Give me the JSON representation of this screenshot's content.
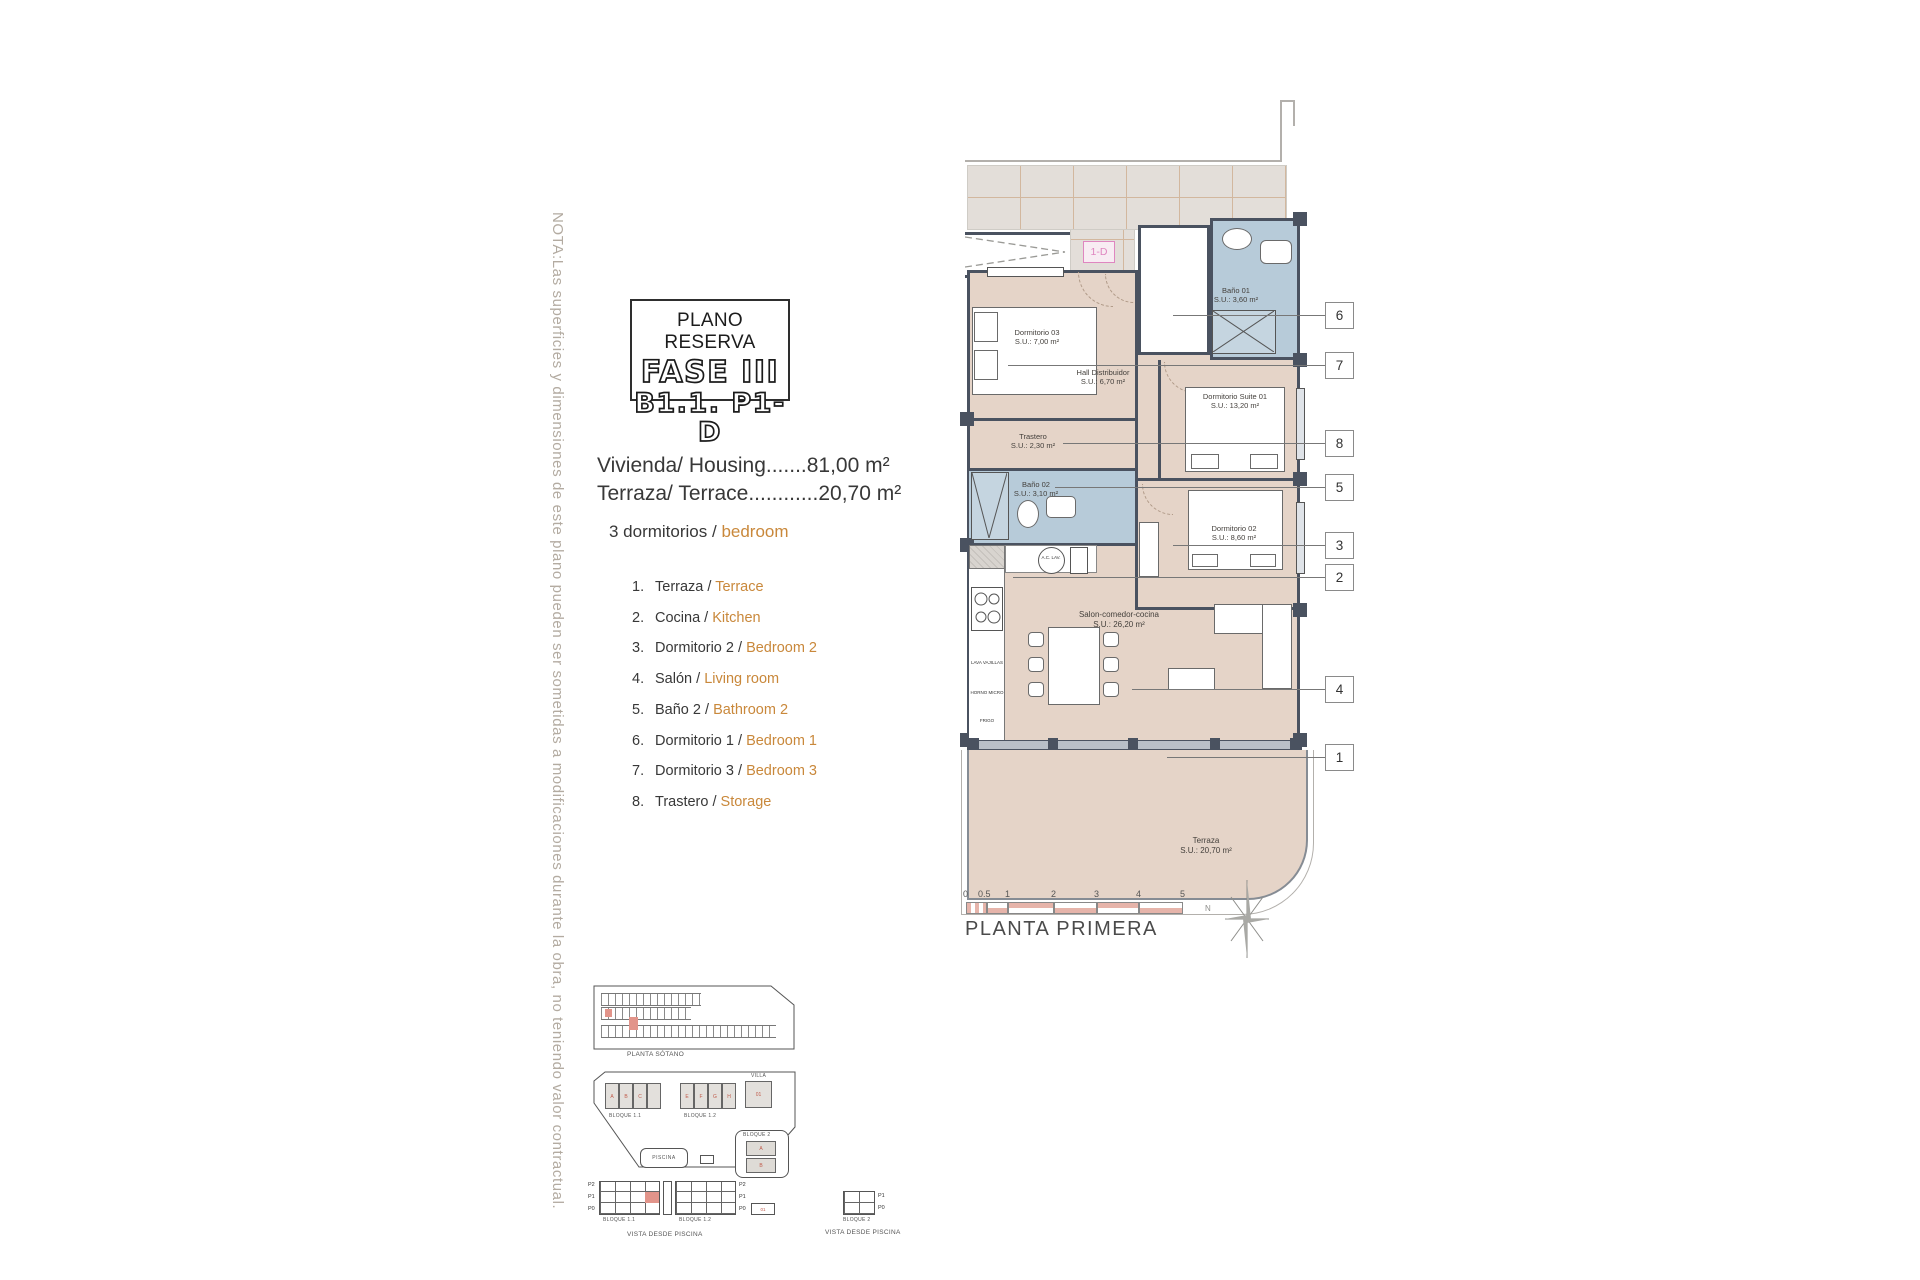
{
  "colors": {
    "accent_orange": "#C9883B",
    "wall": "#4A5260",
    "floor_beige": "#E5D4C8",
    "bath_blue": "#B7CBD9",
    "corridor_gray": "#E3DED9",
    "unit_label_pink": "#DF86C0",
    "scale_pink": "#E6B4AA",
    "highlight_red": "#E2948A",
    "note_gray": "#B3ABA1"
  },
  "note": "NOTA:Las superficies y dimensiones de este plano pueden ser sometidas a modificaciones durante la obra, no teniendo valor contractual.",
  "title_block": {
    "line1": "PLANO RESERVA",
    "line2": "FASE III",
    "line3": "B1.1. P1-D"
  },
  "areas": {
    "housing": "Vivienda/ Housing.......81,00 m²",
    "terrace": "Terraza/ Terrace............20,70 m²"
  },
  "bedrooms": {
    "es": "3 dormitorios",
    "sep": " / ",
    "en": "bedroom"
  },
  "legend_sep": "/",
  "legend": [
    {
      "num": "1.",
      "es": "Terraza",
      "en": "Terrace"
    },
    {
      "num": "2.",
      "es": "Cocina",
      "en": "Kitchen"
    },
    {
      "num": "3.",
      "es": "Dormitorio 2",
      "en": "Bedroom 2"
    },
    {
      "num": "4.",
      "es": "Salón",
      "en": "Living room"
    },
    {
      "num": "5.",
      "es": "Baño 2",
      "en": "Bathroom 2"
    },
    {
      "num": "6.",
      "es": "Dormitorio 1",
      "en": "Bedroom 1"
    },
    {
      "num": "7.",
      "es": "Dormitorio 3",
      "en": "Bedroom 3"
    },
    {
      "num": "8.",
      "es": "Trastero",
      "en": "Storage"
    }
  ],
  "plan": {
    "unit_label": "1-D",
    "floor_caption": "PLANTA PRIMERA",
    "north_label": "N",
    "rooms": {
      "dorm03": {
        "name": "Dormitorio 03",
        "area": "S.U.: 7,00 m²"
      },
      "hall": {
        "name": "Hall Distribuidor",
        "area": "S.U.: 6,70 m²"
      },
      "bano01": {
        "name": "Baño 01",
        "area": "S.U.: 3,60 m²"
      },
      "suite": {
        "name": "Dormitorio Suite 01",
        "area": "S.U.: 13,20 m²"
      },
      "trastero": {
        "name": "Trastero",
        "area": "S.U.: 2,30 m²"
      },
      "bano02": {
        "name": "Baño 02",
        "area": "S.U.: 3,10 m²"
      },
      "dorm02": {
        "name": "Dormitorio 02",
        "area": "S.U.: 8,60 m²"
      },
      "salon": {
        "name": "Salon-comedor-cocina",
        "area": "S.U.: 26,20 m²"
      },
      "terraza": {
        "name": "Terraza",
        "area": "S.U.: 20,70 m²"
      }
    },
    "kitchen": {
      "dishwasher": "LAVA VAJILLAS",
      "oven": "HORNO MICRO",
      "fridge": "FRIGO",
      "washer": "A.C. LAV."
    },
    "callouts": [
      "6",
      "7",
      "8",
      "5",
      "3",
      "2",
      "4",
      "1"
    ],
    "scale_ticks": [
      "0",
      "0.5",
      "1",
      "2",
      "3",
      "4",
      "5"
    ]
  },
  "site": {
    "basement_caption": "PLANTA SÓTANO",
    "block11": "BLOQUE 1.1",
    "block12": "BLOQUE 1.2",
    "block2": "BLOQUE 2",
    "villa": "VILLA",
    "villa_unit": "01",
    "pool": "PISCINA",
    "view_caption": "VISTA DESDE PISCINA",
    "floors": [
      "P2",
      "P1",
      "P0"
    ],
    "floors2": [
      "P1",
      "P0"
    ],
    "units11": [
      "A",
      "B",
      "C"
    ],
    "units12": [
      "E",
      "F",
      "G",
      "H"
    ],
    "units2": [
      "A",
      "B"
    ]
  }
}
